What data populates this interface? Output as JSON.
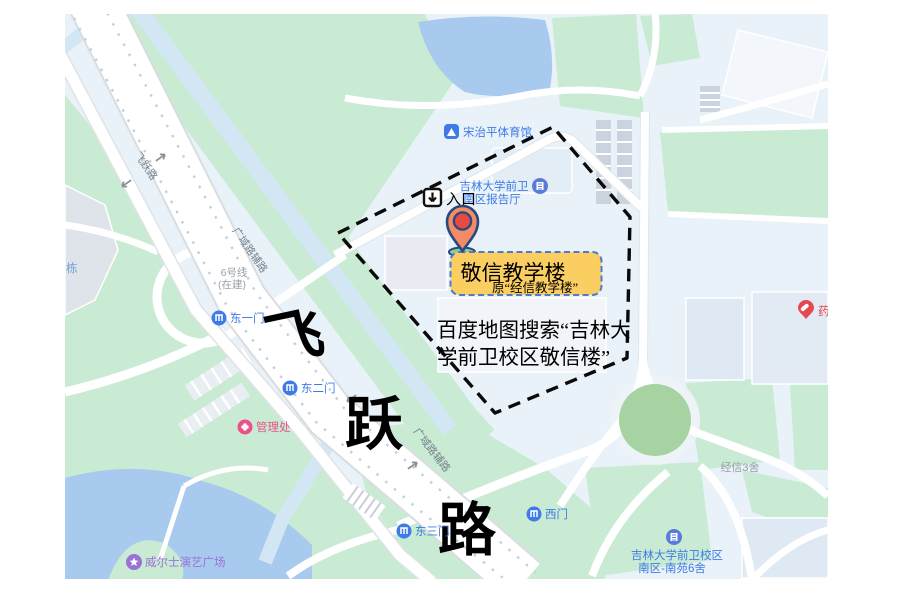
{
  "annotations": {
    "entrance_label": "入口",
    "building_title": "敬信教学楼",
    "building_subtitle": "原“经信教学楼”",
    "search_line1": "百度地图搜索“吉林大",
    "search_line2": "学前卫校区敬信楼”",
    "big_road_char1": "飞",
    "big_road_char2": "跃",
    "big_road_char3": "路"
  },
  "road_labels": {
    "feiyue": "飞跃路",
    "fulu_a": "广域路辅路",
    "fulu_b": "广域路辅路",
    "subway_l1": "6号线",
    "subway_l2": "(在建)"
  },
  "pois": {
    "stadium": "宋治平体育馆",
    "hall_l1": "吉林大学前卫",
    "hall_l2": "南区报告厅",
    "gate_e1": "东一门",
    "gate_e2": "东二门",
    "gate_e3": "东三门",
    "gate_w": "西门",
    "admin": "管理处",
    "plaza": "威尔士演艺广场",
    "dorm3": "经信3舍",
    "campus_l1": "吉林大学前卫校区",
    "campus_l2": "南区-南苑6舍",
    "pharmacy": "药",
    "partial_building": "栋"
  },
  "colors": {
    "park_green": "#C9EBD3",
    "dark_green": "#A7D3A3",
    "water_blue": "#A8CAEE",
    "stream_blue": "#D3E6F4",
    "campus_bg": "#E8F2F8",
    "poi_blue": "#3E7BE8",
    "poi_pink": "#E8528C",
    "poi_purple": "#9B72D8",
    "poi_red": "#E5484D",
    "poi_grey": "#96A0A6",
    "marker_body": "#F48B66",
    "marker_inner": "#E64A41",
    "marker_outline": "#28497F",
    "highlight_fill": "#FBCE62",
    "highlight_border": "#4F79CC",
    "boundary_black": "#0A0A0A"
  }
}
